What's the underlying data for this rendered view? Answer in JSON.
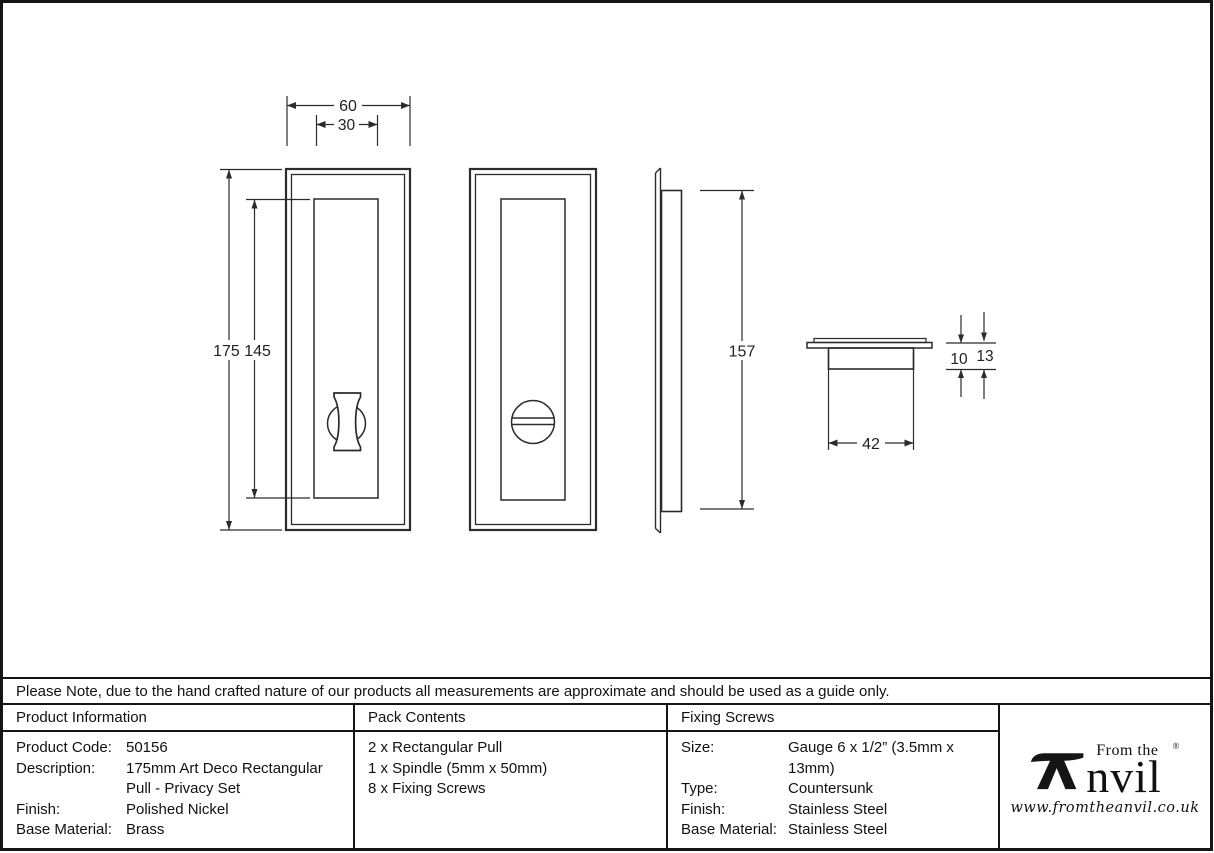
{
  "note": "Please Note, due to the hand crafted nature of our products all measurements are approximate and should be used as a guide only.",
  "drawing": {
    "dims": {
      "outer_width": "60",
      "inner_width": "30",
      "heights": "175 145",
      "side_height": "157",
      "base_width": "42",
      "depth_inner": "10",
      "depth_total": "13"
    }
  },
  "table": {
    "product_information": {
      "header": "Product Information",
      "rows": [
        {
          "label": "Product Code:",
          "value": "50156"
        },
        {
          "label": "Description:",
          "value": "175mm Art Deco Rectangular Pull - Privacy Set"
        },
        {
          "label": "Finish:",
          "value": "Polished Nickel"
        },
        {
          "label": "Base Material:",
          "value": "Brass"
        }
      ]
    },
    "pack_contents": {
      "header": "Pack Contents",
      "items": [
        "2 x Rectangular Pull",
        "1 x Spindle (5mm x 50mm)",
        "8 x Fixing Screws"
      ]
    },
    "fixing_screws": {
      "header": "Fixing Screws",
      "rows": [
        {
          "label": "Size:",
          "value": "Gauge 6 x 1/2” (3.5mm x 13mm)"
        },
        {
          "label": "Type:",
          "value": "Countersunk"
        },
        {
          "label": "Finish:",
          "value": "Stainless Steel"
        },
        {
          "label": "Base Material:",
          "value": "Stainless Steel"
        }
      ]
    }
  },
  "logo": {
    "prefix": "From the",
    "registered": "®",
    "name_rest": "nvil",
    "url": "www.fromtheanvil.co.uk"
  }
}
